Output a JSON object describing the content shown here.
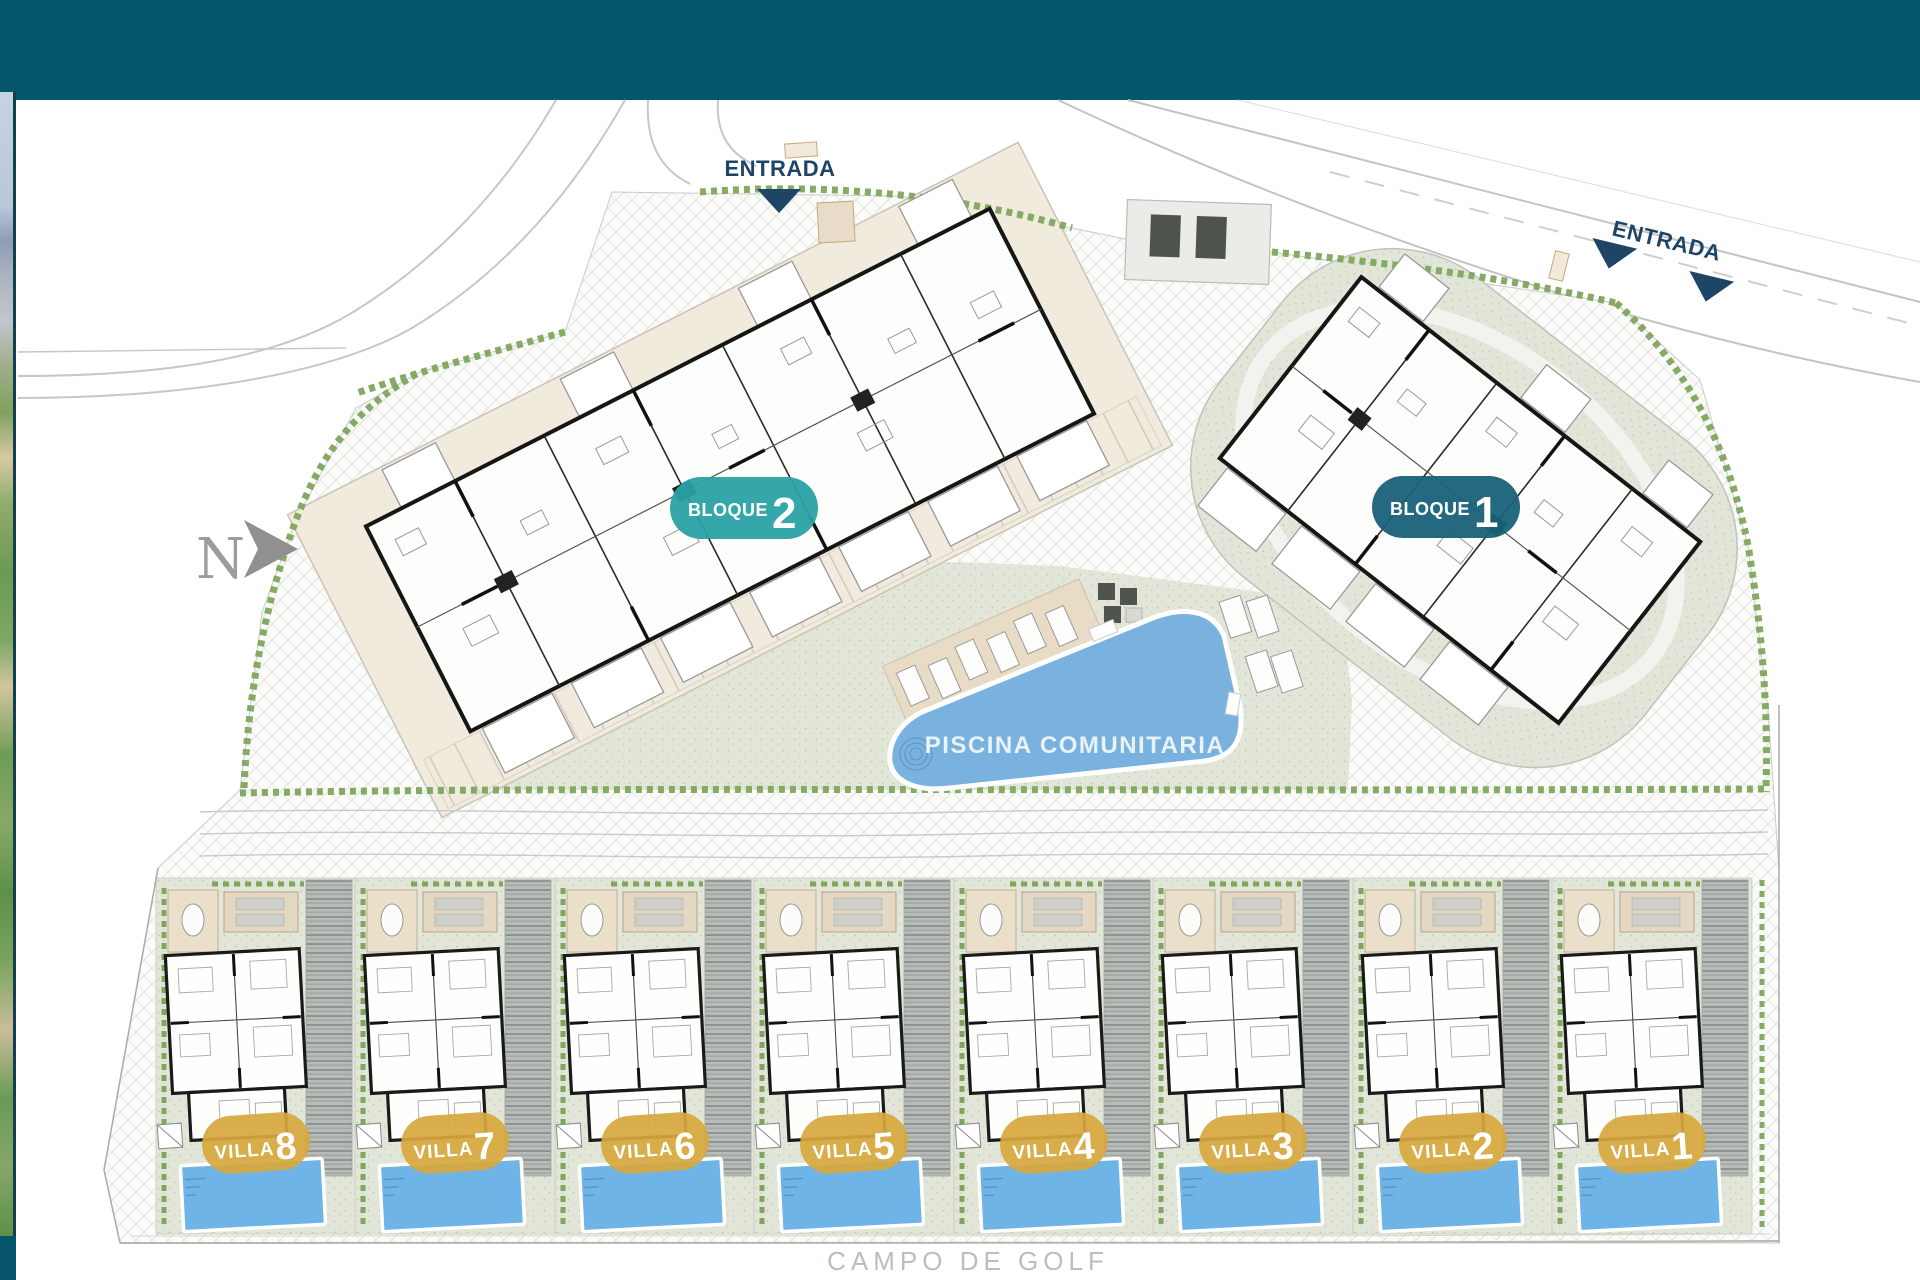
{
  "header": {
    "bg_color": "#05566B"
  },
  "north_arrow": {
    "label": "N"
  },
  "entrances": [
    {
      "label": "ENTRADA",
      "position": "top"
    },
    {
      "label": "ENTRADA",
      "position": "right"
    }
  ],
  "blocks": [
    {
      "label": "BLOQUE",
      "number": "2",
      "badge_color": "#2AA2A6"
    },
    {
      "label": "BLOQUE",
      "number": "1",
      "badge_color": "#186178"
    }
  ],
  "pool": {
    "label": "PISCINA COMUNITARIA",
    "water_color": "#79B2DF"
  },
  "villas": [
    {
      "label": "VILLA",
      "number": "8"
    },
    {
      "label": "VILLA",
      "number": "7"
    },
    {
      "label": "VILLA",
      "number": "6"
    },
    {
      "label": "VILLA",
      "number": "5"
    },
    {
      "label": "VILLA",
      "number": "4"
    },
    {
      "label": "VILLA",
      "number": "3"
    },
    {
      "label": "VILLA",
      "number": "2"
    },
    {
      "label": "VILLA",
      "number": "1"
    }
  ],
  "golf": {
    "label": "CAMPO DE GOLF"
  },
  "colors": {
    "villa_badge_gold": "#D7A83E",
    "villa_pool_blue": "#6FB4E6",
    "hedge_green": "#7EA65D",
    "sage_paving": "#E1E6D8",
    "beige_paving": "#F1EBDD",
    "label_navy": "#1E4466",
    "golf_text_gray": "#BAC0B7",
    "north_gray": "#9C9C9C"
  }
}
